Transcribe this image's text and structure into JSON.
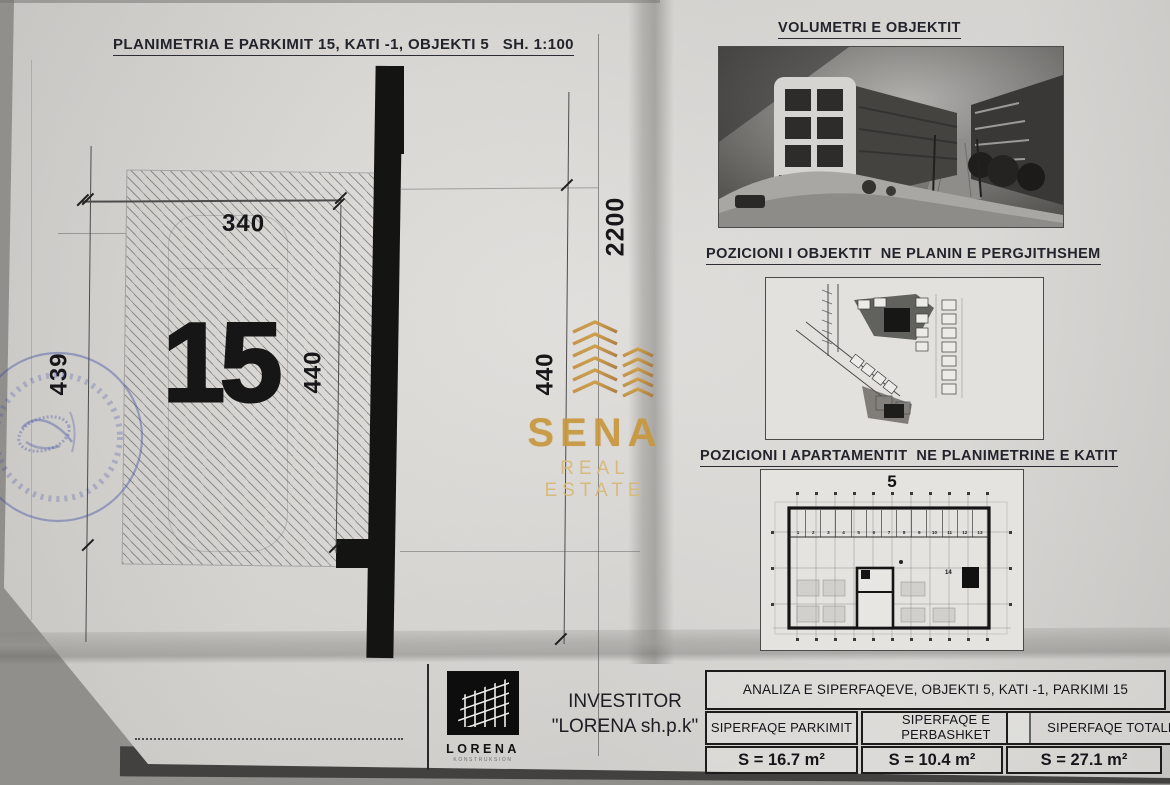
{
  "left": {
    "title": "PLANIMETRIA E PARKIMIT 15, KATI -1, OBJEKTI 5   SH. 1:100",
    "parking_number": "15",
    "dims": {
      "top": "340",
      "left": "439",
      "right": "440",
      "mid": "440",
      "total": "2200"
    }
  },
  "watermark": {
    "brand": "SENA",
    "tagline": "REAL ESTATE"
  },
  "right": {
    "volumetri_title": "VOLUMETRI E OBJEKTIT",
    "site_title": "POZICIONI I OBJEKTIT  NE PLANIN E PERGJITHSHEM",
    "floor_title": "POZICIONI I APARTAMENTIT  NE PLANIMETRINE E KATIT",
    "floor_label": "5",
    "stalls": [
      "1",
      "2",
      "3",
      "4",
      "5",
      "6",
      "7",
      "8",
      "9",
      "10",
      "11",
      "12",
      "13"
    ],
    "highlight_label": "14"
  },
  "footer": {
    "investor_label": "INVESTITOR",
    "investor_name": "\"LORENA sh.p.k\"",
    "logo_text": "LORENA",
    "logo_subtext": "KONSTRUKSION",
    "analysis_title": "ANALIZA E SIPERFAQEVE, OBJEKTI 5, KATI -1, PARKIMI 15",
    "columns": [
      {
        "header": "SIPERFAQE PARKIMIT",
        "value": "S = 16.7 m²"
      },
      {
        "header": "SIPERFAQE E PERBASHKET",
        "value": "S = 10.4 m²"
      },
      {
        "header": "SIPERFAQE TOTALE",
        "value": "S = 27.1 m²"
      }
    ]
  }
}
